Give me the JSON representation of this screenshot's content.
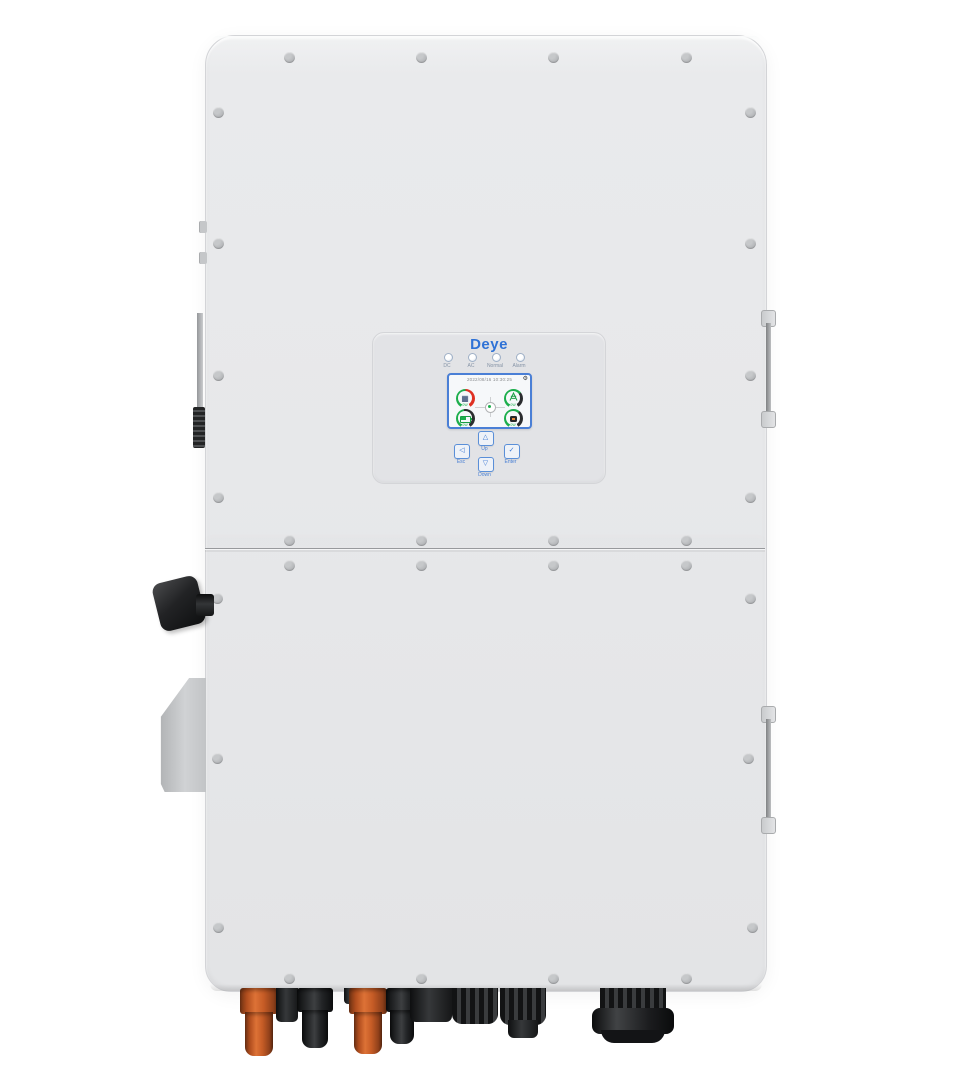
{
  "device": {
    "name": "Deye hybrid inverter — front view"
  },
  "panel": {
    "logo": "Deye",
    "leds": [
      {
        "label": "DC"
      },
      {
        "label": "AC"
      },
      {
        "label": "Normal"
      },
      {
        "label": "Alarm"
      }
    ],
    "screen": {
      "status_text": "2022/08/16 10:30:25",
      "gear_icon": "⚙",
      "gauges": [
        {
          "name": "pv",
          "value_text": "0W"
        },
        {
          "name": "grid",
          "value_text": "0W"
        },
        {
          "name": "battery",
          "value_text": "0W"
        },
        {
          "name": "load",
          "value_text": "0W"
        }
      ]
    },
    "buttons": [
      {
        "id": "esc",
        "label": "Esc",
        "glyph": "◁"
      },
      {
        "id": "up",
        "label": "Up",
        "glyph": "△"
      },
      {
        "id": "down",
        "label": "Down",
        "glyph": "▽"
      },
      {
        "id": "enter",
        "label": "Enter",
        "glyph": "✓"
      }
    ]
  },
  "colors": {
    "brand_blue": "#2f72d6",
    "screen_green": "#1cae4c",
    "screen_red": "#df3022",
    "body_grey": "#e7e8ea",
    "connector_orange": "#c65c26"
  }
}
